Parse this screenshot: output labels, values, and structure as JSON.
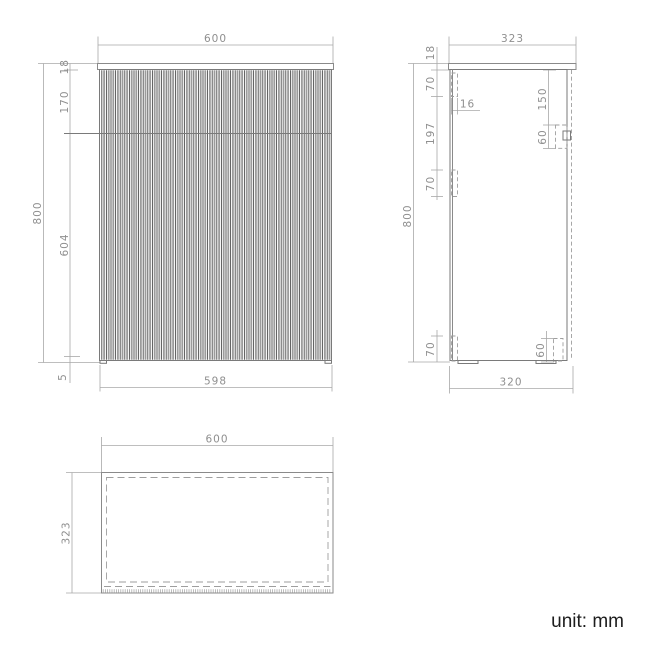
{
  "unit_label": "unit: mm",
  "colors": {
    "object_line": "#8a8a8a",
    "dimension_line": "#a8a8a8",
    "dimension_text": "#8f8f8f",
    "unit_text": "#1d1d1d",
    "flute_dark": "#4a4a4a",
    "flute_gray": "#9b9b9b"
  },
  "front_view": {
    "width_top": "600",
    "height_total": "800",
    "countertop_thickness": "18",
    "drawer_front_height": "170",
    "door_height": "604",
    "bottom_gap": "5",
    "width_body": "598"
  },
  "side_view": {
    "depth_top": "323",
    "countertop_thickness": "18",
    "rail_top_height": "70",
    "rail_thickness": "16",
    "rail_gap": "197",
    "rail_mid_height": "70",
    "handle_offset_top": "150",
    "handle_height": "60",
    "rail_bottom_height": "70",
    "bottom_bracket_height": "60",
    "height_total": "800",
    "depth_body": "320"
  },
  "top_view": {
    "width": "600",
    "depth": "323"
  }
}
